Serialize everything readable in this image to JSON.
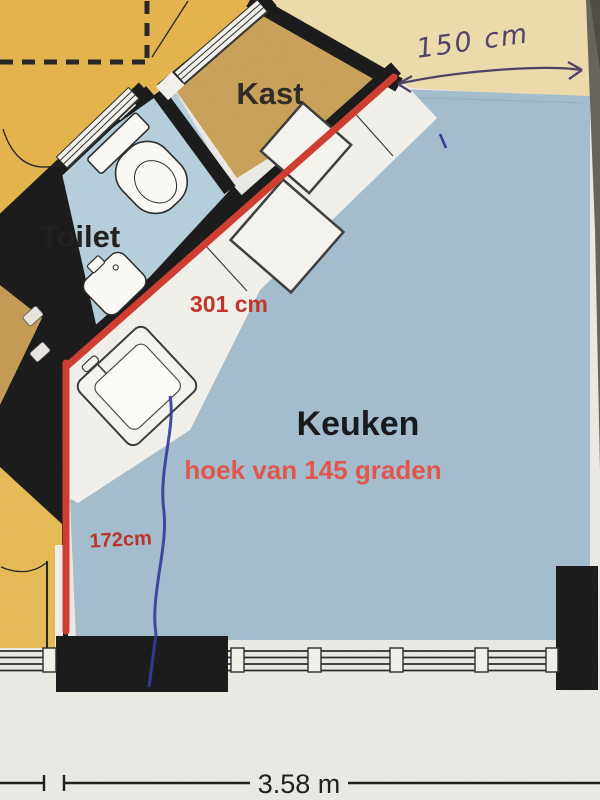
{
  "document": {
    "type": "floor-plan-photo",
    "description": "hand-annotated printed kitchen floor plan"
  },
  "rooms": {
    "kast": "Kast",
    "toilet": "Toilet",
    "keuken": "Keuken"
  },
  "annotations": {
    "counter_length": "301 cm",
    "angle_note": "hoek van 145 graden",
    "left_wall_length": "172cm",
    "handwritten_top_width": "150 cm",
    "bottom_total_width": "3.58 m"
  },
  "colors": {
    "kitchen_floor": "#a3bdcd",
    "toilet_floor": "#b6cedb",
    "hall_floor": "#e4b44b",
    "kast_floor": "#c8a158",
    "paper_cream": "#ecdcab",
    "wall_black": "#181818",
    "marker_red": "#d13a2e",
    "annotation_red": "#c23128",
    "angle_red": "#e1544b",
    "pen_blue": "#31399b",
    "ink_purple": "#4c4166",
    "paper_white": "#ebe9e4"
  }
}
